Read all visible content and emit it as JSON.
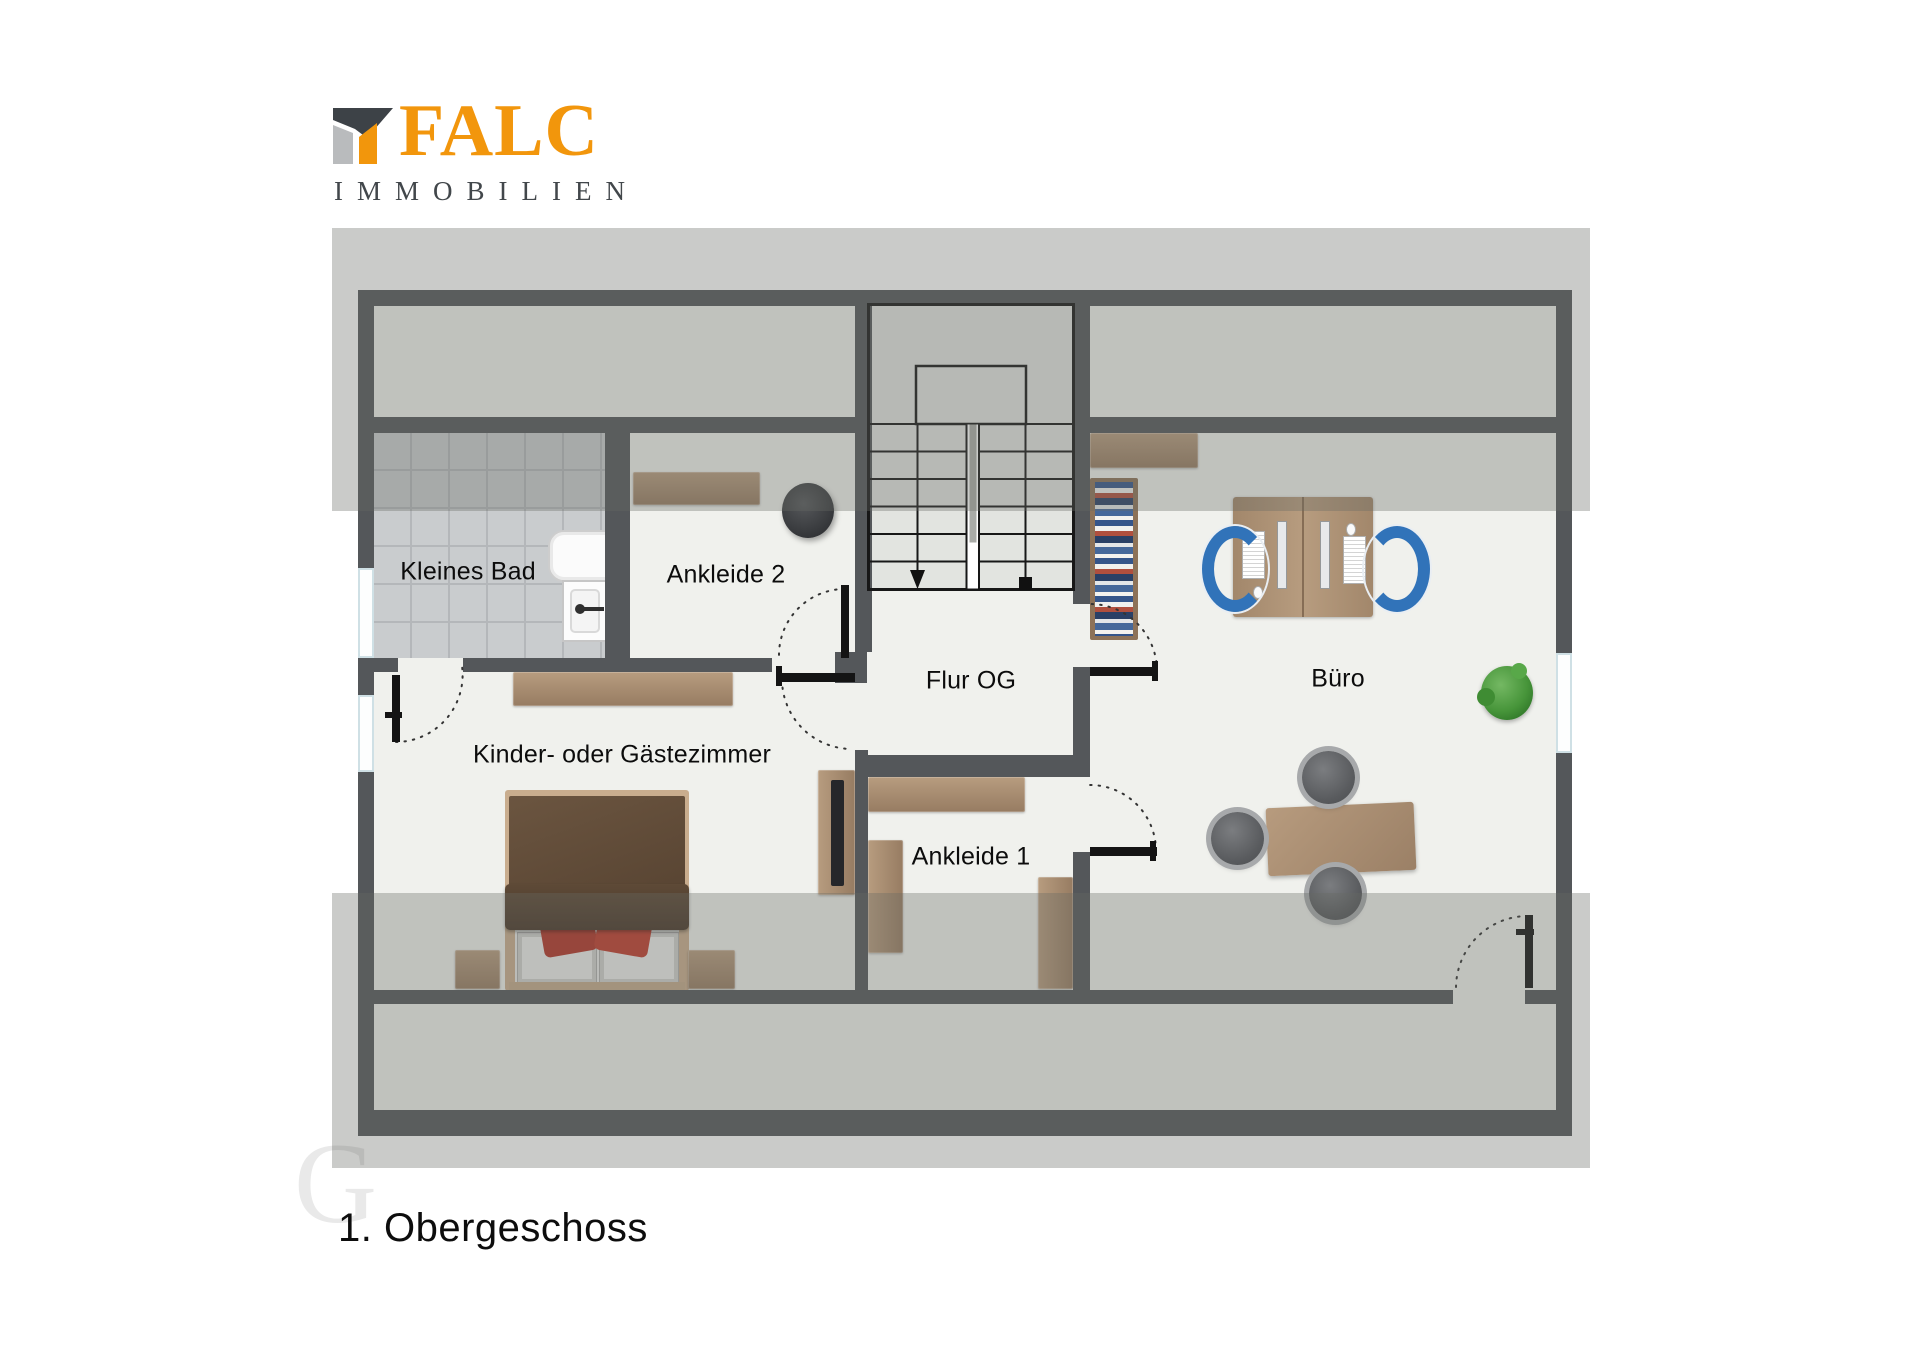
{
  "logo": {
    "brand": "FALC",
    "subtitle": "IMMOBILIEN"
  },
  "floor_title": "1. Obergeschoss",
  "watermark": "G",
  "rooms": {
    "kleines_bad": "Kleines Bad",
    "ankleide_2": "Ankleide 2",
    "flur_og": "Flur OG",
    "buero": "Büro",
    "kinder_gaestezimmer": "Kinder- oder Gästezimmer",
    "ankleide_1": "Ankleide 1"
  },
  "colors": {
    "accent_orange": "#F2960C",
    "logo_dark": "#3D4247",
    "logo_gray": "#B9BBBD",
    "wall": "#54575A",
    "floor": "#F0F1ED",
    "tile": "#C9CCCE",
    "roof_overlay_band": "#C8C9CA",
    "wood": "#AF947A",
    "bed_blanket": "#5E4A37",
    "pillow_red": "#B8392B",
    "office_chair_blue": "#3173B9",
    "plant_green": "#47953A",
    "label_text": "#0C0C0C"
  }
}
